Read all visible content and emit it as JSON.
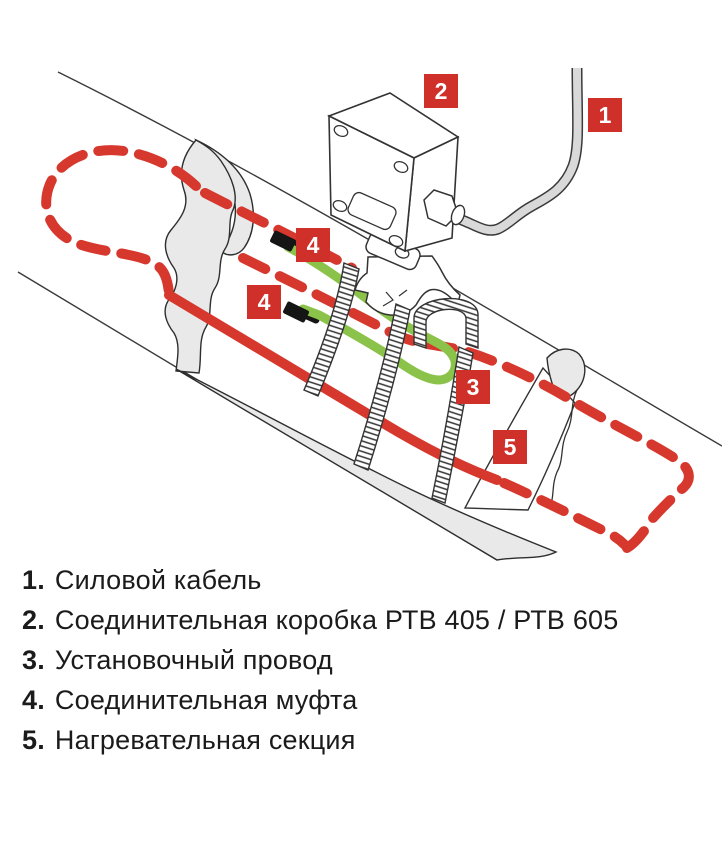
{
  "diagram": {
    "badges": {
      "power_cable": "1",
      "junction_box": "2",
      "installation_wire": "3",
      "coupling_upper": "4",
      "coupling_lower": "4",
      "heating_section": "5"
    }
  },
  "legend": {
    "items": [
      {
        "num": "1.",
        "label": "Силовой кабель"
      },
      {
        "num": "2.",
        "label": "Соединительная коробка РТВ 405 / РТВ 605"
      },
      {
        "num": "3.",
        "label": "Установочный провод"
      },
      {
        "num": "4.",
        "label": "Соединительная муфта"
      },
      {
        "num": "5.",
        "label": "Нагревательная секция"
      }
    ]
  },
  "colors": {
    "accent_red": "#d0302a",
    "cable_red": "#d6382e",
    "wire_green": "#8bc34a",
    "insulation_gray": "#e9e9e9",
    "power_cable_gray": "#d9d9d9",
    "outline_dark": "#333333",
    "text_black": "#1b1b1b"
  }
}
